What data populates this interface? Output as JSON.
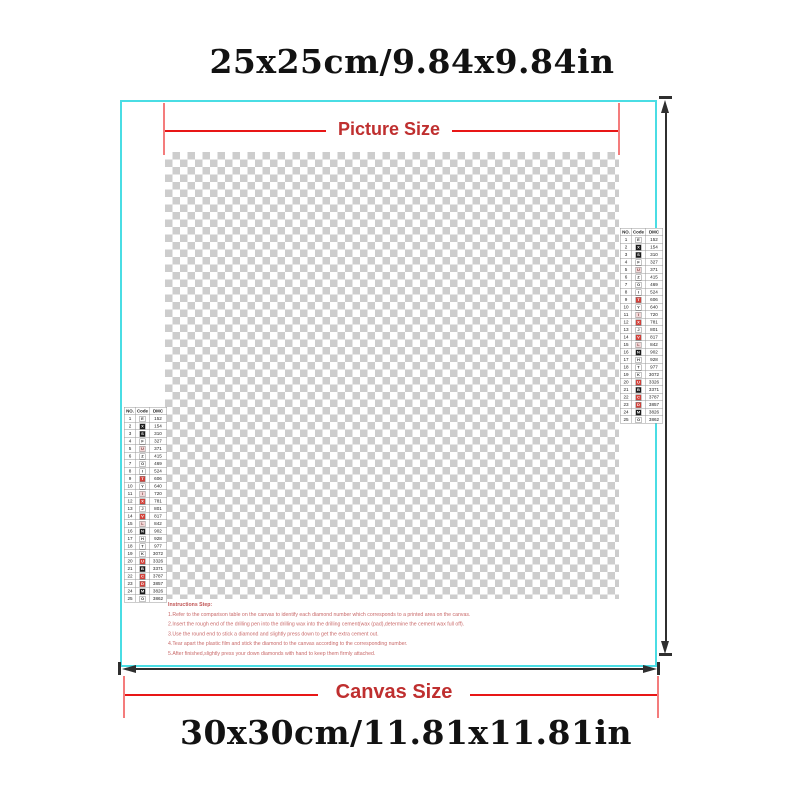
{
  "header": {
    "picture_dimensions": "25x25cm/9.84x9.84in"
  },
  "footer": {
    "canvas_dimensions": "30x30cm/11.81x11.81in"
  },
  "annotations": {
    "picture_size_label": "Picture Size",
    "canvas_size_label": "Canvas Size"
  },
  "colors": {
    "border-cyan": "#4ADDE4",
    "line-red": "#E81717",
    "tick-red": "#F47C7C",
    "label-red": "#BF2F2F",
    "arrow-black": "#2F2F2F",
    "checker-gray": "#CDCDCD",
    "instr-red": "#C96A6A",
    "text-black": "#121212"
  },
  "legend": {
    "headers": [
      "NO.",
      "Code",
      "DMC"
    ],
    "rows": [
      {
        "no": "1",
        "sym": "E",
        "bg": "#FFFFFF",
        "fg": "#333333",
        "dmc": "152"
      },
      {
        "no": "2",
        "sym": "X",
        "bg": "#1A1A1A",
        "fg": "#FFFFFF",
        "dmc": "154"
      },
      {
        "no": "3",
        "sym": "S",
        "bg": "#1A1A1A",
        "fg": "#FFFFFF",
        "dmc": "310"
      },
      {
        "no": "4",
        "sym": "F",
        "bg": "#FFFFFF",
        "fg": "#333333",
        "dmc": "327"
      },
      {
        "no": "5",
        "sym": "U",
        "bg": "#F3D7D7",
        "fg": "#7A3A3A",
        "dmc": "371"
      },
      {
        "no": "6",
        "sym": "Z",
        "bg": "#FFFFFF",
        "fg": "#333333",
        "dmc": "415"
      },
      {
        "no": "7",
        "sym": "O",
        "bg": "#FFFFFF",
        "fg": "#333333",
        "dmc": "469"
      },
      {
        "no": "8",
        "sym": "I",
        "bg": "#FFFFFF",
        "fg": "#333333",
        "dmc": "524"
      },
      {
        "no": "9",
        "sym": "T",
        "bg": "#D2413A",
        "fg": "#FFFFFF",
        "dmc": "606"
      },
      {
        "no": "10",
        "sym": "Y",
        "bg": "#FFFFFF",
        "fg": "#333333",
        "dmc": "640"
      },
      {
        "no": "11",
        "sym": "I",
        "bg": "#F3D7D7",
        "fg": "#7A3A3A",
        "dmc": "720"
      },
      {
        "no": "12",
        "sym": "X",
        "bg": "#D2413A",
        "fg": "#FFFFFF",
        "dmc": "781"
      },
      {
        "no": "13",
        "sym": "J",
        "bg": "#FFFFFF",
        "fg": "#333333",
        "dmc": "801"
      },
      {
        "no": "14",
        "sym": "V",
        "bg": "#D2413A",
        "fg": "#FFFFFF",
        "dmc": "817"
      },
      {
        "no": "15",
        "sym": "L",
        "bg": "#F3D7D7",
        "fg": "#7A3A3A",
        "dmc": "842"
      },
      {
        "no": "16",
        "sym": "N",
        "bg": "#1A1A1A",
        "fg": "#FFFFFF",
        "dmc": "902"
      },
      {
        "no": "17",
        "sym": "H",
        "bg": "#FFFFFF",
        "fg": "#333333",
        "dmc": "928"
      },
      {
        "no": "18",
        "sym": "T",
        "bg": "#FFFFFF",
        "fg": "#333333",
        "dmc": "977"
      },
      {
        "no": "19",
        "sym": "K",
        "bg": "#FFFFFF",
        "fg": "#333333",
        "dmc": "3072"
      },
      {
        "no": "20",
        "sym": "U",
        "bg": "#D2413A",
        "fg": "#FFFFFF",
        "dmc": "3326"
      },
      {
        "no": "21",
        "sym": "B",
        "bg": "#1A1A1A",
        "fg": "#FFFFFF",
        "dmc": "3371"
      },
      {
        "no": "22",
        "sym": "C",
        "bg": "#D2413A",
        "fg": "#FFFFFF",
        "dmc": "3787"
      },
      {
        "no": "23",
        "sym": "D",
        "bg": "#D2413A",
        "fg": "#FFFFFF",
        "dmc": "3857"
      },
      {
        "no": "24",
        "sym": "M",
        "bg": "#1A1A1A",
        "fg": "#FFFFFF",
        "dmc": "3826"
      },
      {
        "no": "25",
        "sym": "O",
        "bg": "#FFFFFF",
        "fg": "#333333",
        "dmc": "3862"
      }
    ]
  },
  "instructions": {
    "title": "Instructions Step:",
    "steps": [
      "1.Refer to the comparison table on the canvas to identify each diamond number which corresponds to a printed area on the canvas.",
      "2.Insert the rough end of the drilling pen into the drilling wax into the drilling cement(wax (pad),determine the cement wax full off).",
      "3.Use the round end to stick a diamond and slightly press down to get the extra cement out.",
      "4.Tear apart the plastic film and stick the diamond to the canvas according to the corresponding number.",
      "5.After finished,slightly press your down diamonds with hand to keep them firmly attached."
    ]
  }
}
